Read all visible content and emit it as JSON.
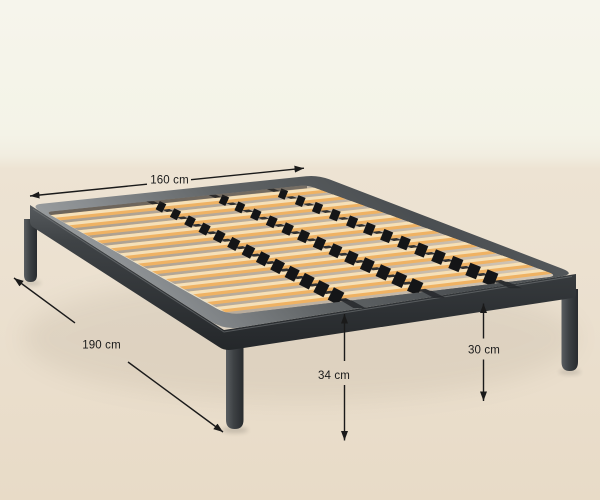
{
  "image": {
    "kind": "product-dimension-diagram",
    "subject": "metal platform bed frame with wooden slats, shown in perspective on a beige floor against a cream wall"
  },
  "dimensions": {
    "width": {
      "label": "160 cm"
    },
    "length": {
      "label": "190 cm"
    },
    "height_to_top": {
      "label": "34 cm"
    },
    "leg_height": {
      "label": "30 cm"
    }
  },
  "palette": {
    "wall": "#f4f3e7",
    "floor": "#ebe0cf",
    "frame": "#4a4e51",
    "frame_dark": "#2a2d30",
    "slat_top": "#f4e3bd",
    "slat_face": "#efb263",
    "deck_gap_dark": "#a89c8d",
    "deck_gap_light": "#d2c6b6",
    "strap": "#232528",
    "clip": "#141517",
    "annotation": "#1a1a1a"
  }
}
